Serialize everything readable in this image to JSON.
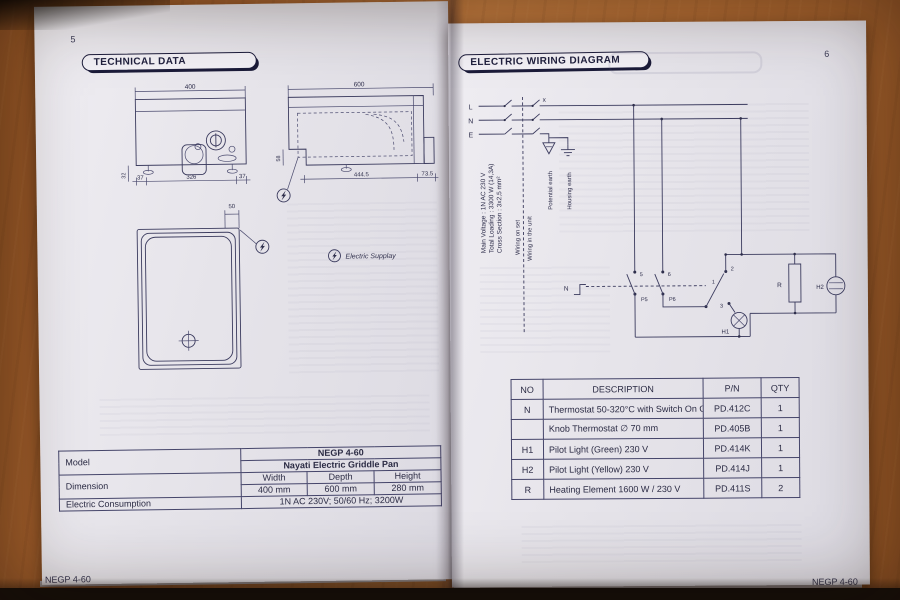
{
  "left_page": {
    "page_number": "5",
    "title": "TECHNICAL DATA",
    "front_view": {
      "dim_width_top": "400",
      "dim_left": "32",
      "dim_bottom_left": "37",
      "dim_bottom_center": "326",
      "dim_bottom_right": "37"
    },
    "side_view": {
      "dim_width_top": "600",
      "dim_left": "58",
      "dim_bottom_main": "444.5",
      "dim_bottom_right": "73.5"
    },
    "plan_view": {
      "dim_supply_offset": "50"
    },
    "legend_electric_supply": "Electric Supplay",
    "spec_table": {
      "model_label": "Model",
      "model_value_line1": "NEGP 4-60",
      "model_value_line2": "Nayati Electric Griddle Pan",
      "dimension_label": "Dimension",
      "dim_headers": [
        "Width",
        "Depth",
        "Height"
      ],
      "dim_values": [
        "400 mm",
        "600 mm",
        "280 mm"
      ],
      "consumption_label": "Electric Consumption",
      "consumption_value": "1N AC 230V; 50/60 Hz; 3200W"
    },
    "footer": "NEGP 4-60"
  },
  "right_page": {
    "page_number": "6",
    "title": "ELECTRIC WIRING DIAGRAM",
    "wiring": {
      "phase_labels": [
        "L",
        "N",
        "E"
      ],
      "x_mark": "x",
      "spec_main_voltage": "Main Voltage : 1N AC 230 V",
      "spec_total_loading": "Total Loading : 3300 W (14,3A)",
      "spec_cross_section": "Cross Section : 3x2,5 mm²",
      "boundary_label_left": "Wiring on set",
      "boundary_label_right": "Wiring in the unit",
      "potential_earth_label": "Potential earth",
      "housing_earth_label": "Housing earth",
      "labels": {
        "n": "N",
        "c5": "5",
        "p5": "P5",
        "c6": "6",
        "p6": "P6",
        "t1": "1",
        "t2": "2",
        "t3": "3",
        "h1": "H1",
        "h2": "H2",
        "r": "R"
      }
    },
    "parts_table": {
      "headers": [
        "NO",
        "DESCRIPTION",
        "P/N",
        "QTY"
      ],
      "rows": [
        [
          "N",
          "Thermostat 50-320°C with Switch On Off",
          "PD.412C",
          "1"
        ],
        [
          "",
          "Knob Thermostat ∅ 70 mm",
          "PD.405B",
          "1"
        ],
        [
          "H1",
          "Pilot Light (Green) 230 V",
          "PD.414K",
          "1"
        ],
        [
          "H2",
          "Pilot Light (Yellow) 230 V",
          "PD.414J",
          "1"
        ],
        [
          "R",
          "Heating Element 1600 W / 230 V",
          "PD.411S",
          "2"
        ]
      ]
    },
    "footer": "NEGP 4-60"
  }
}
